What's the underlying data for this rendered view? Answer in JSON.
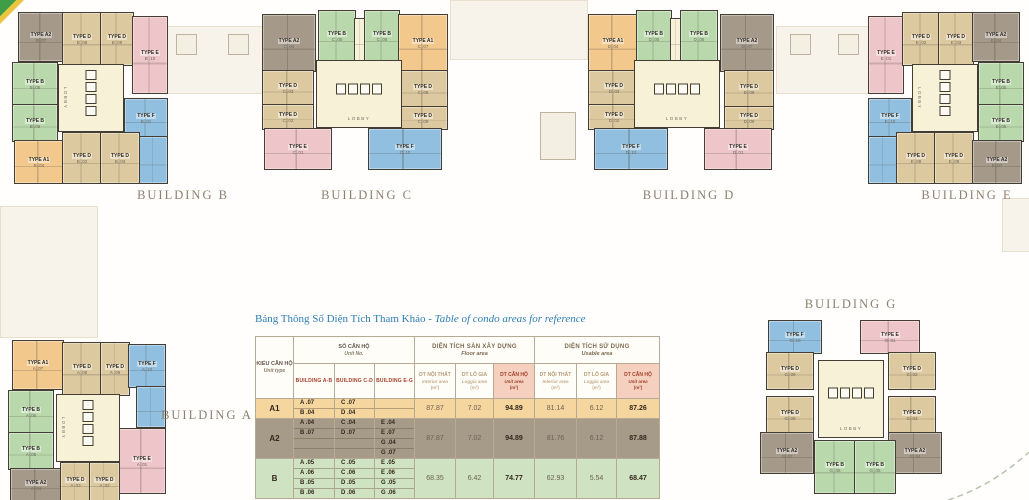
{
  "site": {
    "lobby_label": "LOBBY",
    "palette": {
      "A1": "#f2c88d",
      "A2": "#a59a8a",
      "B": "#b9d9ad",
      "D": "#dcc9a0",
      "E": "#eec5c9",
      "F": "#91bfdf",
      "L": "#f7f1d8"
    },
    "colors": {
      "wall": "#433d33",
      "building_label": "#8b8172",
      "title_blue": "#2e7eb4",
      "road_dash": "#b8c3ad"
    }
  },
  "decor": [
    {
      "x": 166,
      "y": 26,
      "w": 96,
      "h": 66,
      "cls": "pod"
    },
    {
      "x": 176,
      "y": 34,
      "w": 19,
      "h": 19,
      "cls": "sq"
    },
    {
      "x": 228,
      "y": 34,
      "w": 19,
      "h": 19,
      "cls": "sq"
    },
    {
      "x": 450,
      "y": 0,
      "w": 136,
      "h": 58,
      "cls": "pod"
    },
    {
      "x": 540,
      "y": 112,
      "w": 34,
      "h": 46,
      "cls": "sq"
    },
    {
      "x": 776,
      "y": 26,
      "w": 92,
      "h": 66,
      "cls": "pod"
    },
    {
      "x": 790,
      "y": 34,
      "w": 19,
      "h": 19,
      "cls": "sq"
    },
    {
      "x": 838,
      "y": 34,
      "w": 19,
      "h": 19,
      "cls": "sq"
    },
    {
      "x": 0,
      "y": 206,
      "w": 96,
      "h": 130,
      "cls": "pod"
    },
    {
      "x": 1002,
      "y": 198,
      "w": 27,
      "h": 52,
      "cls": "pod"
    }
  ],
  "buildings": [
    {
      "label": "BUILDING B",
      "lx": 128,
      "ly": 188,
      "lobby": {
        "x": 58,
        "y": 64,
        "w": 64,
        "h": 66,
        "o": "v"
      },
      "units": [
        {
          "t": "TYPE A2",
          "n": "B .07",
          "c": "A2",
          "x": 18,
          "y": 12,
          "w": 44,
          "h": 48
        },
        {
          "t": "TYPE D",
          "n": "B .08",
          "c": "D",
          "x": 62,
          "y": 12,
          "w": 38,
          "h": 52
        },
        {
          "t": "TYPE D",
          "n": "B .09",
          "c": "D",
          "x": 100,
          "y": 12,
          "w": 32,
          "h": 52
        },
        {
          "t": "TYPE E",
          "n": "B .10",
          "c": "E",
          "x": 132,
          "y": 16,
          "w": 34,
          "h": 76
        },
        {
          "t": "TYPE B",
          "n": "B .05",
          "c": "B",
          "x": 12,
          "y": 62,
          "w": 44,
          "h": 42
        },
        {
          "t": "TYPE B",
          "n": "B .06",
          "c": "B",
          "x": 12,
          "y": 104,
          "w": 44,
          "h": 36
        },
        {
          "t": "TYPE F",
          "n": "B .01",
          "c": "F",
          "x": 124,
          "y": 98,
          "w": 42,
          "h": 38
        },
        {
          "t": "",
          "n": "",
          "c": "F",
          "x": 138,
          "y": 136,
          "w": 28,
          "h": 46
        },
        {
          "t": "TYPE A1",
          "n": "B .04",
          "c": "A1",
          "x": 14,
          "y": 140,
          "w": 48,
          "h": 42
        },
        {
          "t": "TYPE D",
          "n": "B .02",
          "c": "D",
          "x": 62,
          "y": 132,
          "w": 38,
          "h": 50
        },
        {
          "t": "TYPE D",
          "n": "B .03",
          "c": "D",
          "x": 100,
          "y": 132,
          "w": 38,
          "h": 50
        }
      ]
    },
    {
      "label": "BUILDING C",
      "lx": 312,
      "ly": 188,
      "lobby": {
        "x": 316,
        "y": 60,
        "w": 84,
        "h": 66,
        "o": "h"
      },
      "units": [
        {
          "t": "TYPE A2",
          "n": "C .04",
          "c": "A2",
          "x": 262,
          "y": 14,
          "w": 52,
          "h": 56
        },
        {
          "t": "TYPE B",
          "n": "C .05",
          "c": "B",
          "x": 318,
          "y": 10,
          "w": 36,
          "h": 50
        },
        {
          "t": "",
          "n": "",
          "c": "L",
          "x": 354,
          "y": 18,
          "w": 10,
          "h": 42
        },
        {
          "t": "TYPE B",
          "n": "C .06",
          "c": "B",
          "x": 364,
          "y": 10,
          "w": 34,
          "h": 50
        },
        {
          "t": "TYPE A1",
          "n": "C .07",
          "c": "A1",
          "x": 398,
          "y": 14,
          "w": 48,
          "h": 56
        },
        {
          "t": "TYPE D",
          "n": "C .03",
          "c": "D",
          "x": 262,
          "y": 70,
          "w": 50,
          "h": 34
        },
        {
          "t": "TYPE D",
          "n": "C .02",
          "c": "D",
          "x": 262,
          "y": 104,
          "w": 50,
          "h": 24
        },
        {
          "t": "TYPE D",
          "n": "C .08",
          "c": "D",
          "x": 398,
          "y": 70,
          "w": 48,
          "h": 36
        },
        {
          "t": "TYPE D",
          "n": "C .09",
          "c": "D",
          "x": 398,
          "y": 106,
          "w": 48,
          "h": 22
        },
        {
          "t": "TYPE E",
          "n": "C .01",
          "c": "E",
          "x": 264,
          "y": 128,
          "w": 66,
          "h": 40
        },
        {
          "t": "TYPE F",
          "n": "C .10",
          "c": "F",
          "x": 368,
          "y": 128,
          "w": 72,
          "h": 40
        }
      ]
    },
    {
      "label": "BUILDING D",
      "lx": 634,
      "ly": 188,
      "lobby": {
        "x": 634,
        "y": 60,
        "w": 84,
        "h": 66,
        "o": "h"
      },
      "units": [
        {
          "t": "TYPE A1",
          "n": "D .04",
          "c": "A1",
          "x": 588,
          "y": 14,
          "w": 48,
          "h": 56
        },
        {
          "t": "TYPE B",
          "n": "D .05",
          "c": "B",
          "x": 636,
          "y": 10,
          "w": 34,
          "h": 50
        },
        {
          "t": "",
          "n": "",
          "c": "L",
          "x": 670,
          "y": 18,
          "w": 10,
          "h": 42
        },
        {
          "t": "TYPE B",
          "n": "D .06",
          "c": "B",
          "x": 680,
          "y": 10,
          "w": 36,
          "h": 50
        },
        {
          "t": "TYPE A2",
          "n": "D .07",
          "c": "A2",
          "x": 720,
          "y": 14,
          "w": 52,
          "h": 56
        },
        {
          "t": "TYPE D",
          "n": "D .03",
          "c": "D",
          "x": 588,
          "y": 70,
          "w": 50,
          "h": 34
        },
        {
          "t": "TYPE D",
          "n": "D .02",
          "c": "D",
          "x": 588,
          "y": 104,
          "w": 50,
          "h": 24
        },
        {
          "t": "TYPE D",
          "n": "D .08",
          "c": "D",
          "x": 724,
          "y": 70,
          "w": 48,
          "h": 36
        },
        {
          "t": "TYPE D",
          "n": "D .09",
          "c": "D",
          "x": 724,
          "y": 106,
          "w": 48,
          "h": 22
        },
        {
          "t": "TYPE F",
          "n": "D .10",
          "c": "F",
          "x": 594,
          "y": 128,
          "w": 72,
          "h": 40
        },
        {
          "t": "TYPE E",
          "n": "D .01",
          "c": "E",
          "x": 704,
          "y": 128,
          "w": 66,
          "h": 40
        }
      ]
    },
    {
      "label": "BUILDING E",
      "lx": 912,
      "ly": 188,
      "lobby": {
        "x": 912,
        "y": 64,
        "w": 64,
        "h": 66,
        "o": "v"
      },
      "units": [
        {
          "t": "TYPE E",
          "n": "E .01",
          "c": "E",
          "x": 868,
          "y": 16,
          "w": 34,
          "h": 76
        },
        {
          "t": "TYPE D",
          "n": "E .02",
          "c": "D",
          "x": 902,
          "y": 12,
          "w": 36,
          "h": 52
        },
        {
          "t": "TYPE D",
          "n": "E .03",
          "c": "D",
          "x": 938,
          "y": 12,
          "w": 34,
          "h": 52
        },
        {
          "t": "TYPE A2",
          "n": "E .04",
          "c": "A2",
          "x": 972,
          "y": 12,
          "w": 46,
          "h": 48
        },
        {
          "t": "TYPE F",
          "n": "E .10",
          "c": "F",
          "x": 868,
          "y": 98,
          "w": 42,
          "h": 38
        },
        {
          "t": "",
          "n": "",
          "c": "F",
          "x": 868,
          "y": 136,
          "w": 28,
          "h": 46
        },
        {
          "t": "TYPE B",
          "n": "E .05",
          "c": "B",
          "x": 978,
          "y": 62,
          "w": 44,
          "h": 42
        },
        {
          "t": "TYPE B",
          "n": "E .06",
          "c": "B",
          "x": 978,
          "y": 104,
          "w": 44,
          "h": 36
        },
        {
          "t": "TYPE D",
          "n": "E .08",
          "c": "D",
          "x": 896,
          "y": 132,
          "w": 38,
          "h": 50
        },
        {
          "t": "TYPE D",
          "n": "E .09",
          "c": "D",
          "x": 934,
          "y": 132,
          "w": 38,
          "h": 50
        },
        {
          "t": "TYPE A2",
          "n": "E .07",
          "c": "A2",
          "x": 972,
          "y": 140,
          "w": 48,
          "h": 42
        }
      ]
    },
    {
      "label": "BUILDING A",
      "lx": 152,
      "ly": 408,
      "lobby": {
        "x": 56,
        "y": 394,
        "w": 62,
        "h": 66,
        "o": "v"
      },
      "units": [
        {
          "t": "TYPE A1",
          "n": "A .07",
          "c": "A1",
          "x": 12,
          "y": 340,
          "w": 50,
          "h": 48
        },
        {
          "t": "TYPE D",
          "n": "A .08",
          "c": "D",
          "x": 62,
          "y": 342,
          "w": 38,
          "h": 52
        },
        {
          "t": "TYPE D",
          "n": "A .09",
          "c": "D",
          "x": 100,
          "y": 342,
          "w": 28,
          "h": 52
        },
        {
          "t": "TYPE F",
          "n": "A .10",
          "c": "F",
          "x": 128,
          "y": 344,
          "w": 36,
          "h": 42
        },
        {
          "t": "",
          "n": "",
          "c": "F",
          "x": 136,
          "y": 386,
          "w": 28,
          "h": 40
        },
        {
          "t": "TYPE B",
          "n": "A .06",
          "c": "B",
          "x": 8,
          "y": 390,
          "w": 44,
          "h": 42
        },
        {
          "t": "TYPE B",
          "n": "A .05",
          "c": "B",
          "x": 8,
          "y": 432,
          "w": 44,
          "h": 36
        },
        {
          "t": "TYPE E",
          "n": "A .01",
          "c": "E",
          "x": 118,
          "y": 428,
          "w": 46,
          "h": 64
        },
        {
          "t": "TYPE A2",
          "n": "A .04",
          "c": "A2",
          "x": 10,
          "y": 468,
          "w": 50,
          "h": 32
        },
        {
          "t": "TYPE D",
          "n": "A .03",
          "c": "D",
          "x": 60,
          "y": 462,
          "w": 29,
          "h": 38
        },
        {
          "t": "TYPE D",
          "n": "A .02",
          "c": "D",
          "x": 89,
          "y": 462,
          "w": 29,
          "h": 38
        }
      ]
    },
    {
      "label": "BUILDING G",
      "lx": 796,
      "ly": 297,
      "lobby": {
        "x": 818,
        "y": 360,
        "w": 64,
        "h": 76,
        "o": "h"
      },
      "units": [
        {
          "t": "TYPE F",
          "n": "G .10",
          "c": "F",
          "x": 768,
          "y": 320,
          "w": 52,
          "h": 32
        },
        {
          "t": "TYPE E",
          "n": "G .01",
          "c": "E",
          "x": 860,
          "y": 320,
          "w": 58,
          "h": 32
        },
        {
          "t": "TYPE D",
          "n": "G .09",
          "c": "D",
          "x": 766,
          "y": 352,
          "w": 46,
          "h": 36
        },
        {
          "t": "TYPE D",
          "n": "G .02",
          "c": "D",
          "x": 888,
          "y": 352,
          "w": 46,
          "h": 36
        },
        {
          "t": "TYPE D",
          "n": "G .08",
          "c": "D",
          "x": 766,
          "y": 396,
          "w": 46,
          "h": 36
        },
        {
          "t": "TYPE D",
          "n": "G .03",
          "c": "D",
          "x": 888,
          "y": 396,
          "w": 46,
          "h": 36
        },
        {
          "t": "TYPE A2",
          "n": "G .07",
          "c": "A2",
          "x": 760,
          "y": 432,
          "w": 52,
          "h": 40
        },
        {
          "t": "TYPE A2",
          "n": "G .04",
          "c": "A2",
          "x": 888,
          "y": 432,
          "w": 52,
          "h": 40
        },
        {
          "t": "TYPE B",
          "n": "G .06",
          "c": "B",
          "x": 814,
          "y": 440,
          "w": 40,
          "h": 52
        },
        {
          "t": "TYPE B",
          "n": "G .05",
          "c": "B",
          "x": 854,
          "y": 440,
          "w": 40,
          "h": 52
        }
      ]
    }
  ],
  "table": {
    "title_vn": "Bảng Thông Số Diện Tích Tham Khảo -",
    "title_en": "Table of condo areas for reference",
    "col_headers": {
      "unit_type": [
        "KIỂU CĂN HỘ",
        "Unit type"
      ],
      "unit_no": [
        "SỐ CĂN HỘ",
        "Unit No."
      ],
      "floor_area_group": [
        "DIỆN TÍCH SÀN XÂY DỰNG",
        "Floor area"
      ],
      "usable_area_group": [
        "DIỆN TÍCH SỬ DỤNG",
        "Usable area"
      ],
      "buildings": [
        "BUILDING A-B",
        "BUILDING C-D",
        "BUILDING E-G"
      ],
      "interior": [
        "DT NỘI THẤT",
        "Interior area",
        "(m²)"
      ],
      "loggia": [
        "DT LÔ GIA",
        "Loggia area",
        "(m²)"
      ],
      "unit_area": [
        "DT CĂN HỘ",
        "Unit area",
        "(m²)"
      ]
    },
    "rows": [
      {
        "type": "A1",
        "bg": "#f5d69f",
        "ab": [
          "A .07",
          "B .04"
        ],
        "cd": [
          "C .07",
          "D .04"
        ],
        "eg": [
          "",
          ""
        ],
        "floor": [
          "87.87",
          "7.02",
          "94.89"
        ],
        "usable": [
          "81.14",
          "6.12",
          "87.26"
        ]
      },
      {
        "type": "A2",
        "bg": "#a69a89",
        "ab": [
          "A .04",
          "B .07",
          "",
          ""
        ],
        "cd": [
          "C .04",
          "D .07",
          "",
          ""
        ],
        "eg": [
          "E .04",
          "E .07",
          "G .04",
          "G .07"
        ],
        "floor": [
          "87.87",
          "7.02",
          "94.89"
        ],
        "usable": [
          "81.76",
          "6.12",
          "87.88"
        ]
      },
      {
        "type": "B",
        "bg": "#cfe2c1",
        "ab": [
          "A .05",
          "A .06",
          "B .05",
          "B .06"
        ],
        "cd": [
          "C .05",
          "C .06",
          "D .05",
          "D .06"
        ],
        "eg": [
          "E .05",
          "E .06",
          "G .05",
          "G .06"
        ],
        "floor": [
          "68.35",
          "6.42",
          "74.77"
        ],
        "usable": [
          "62.93",
          "5.54",
          "68.47"
        ]
      }
    ]
  }
}
